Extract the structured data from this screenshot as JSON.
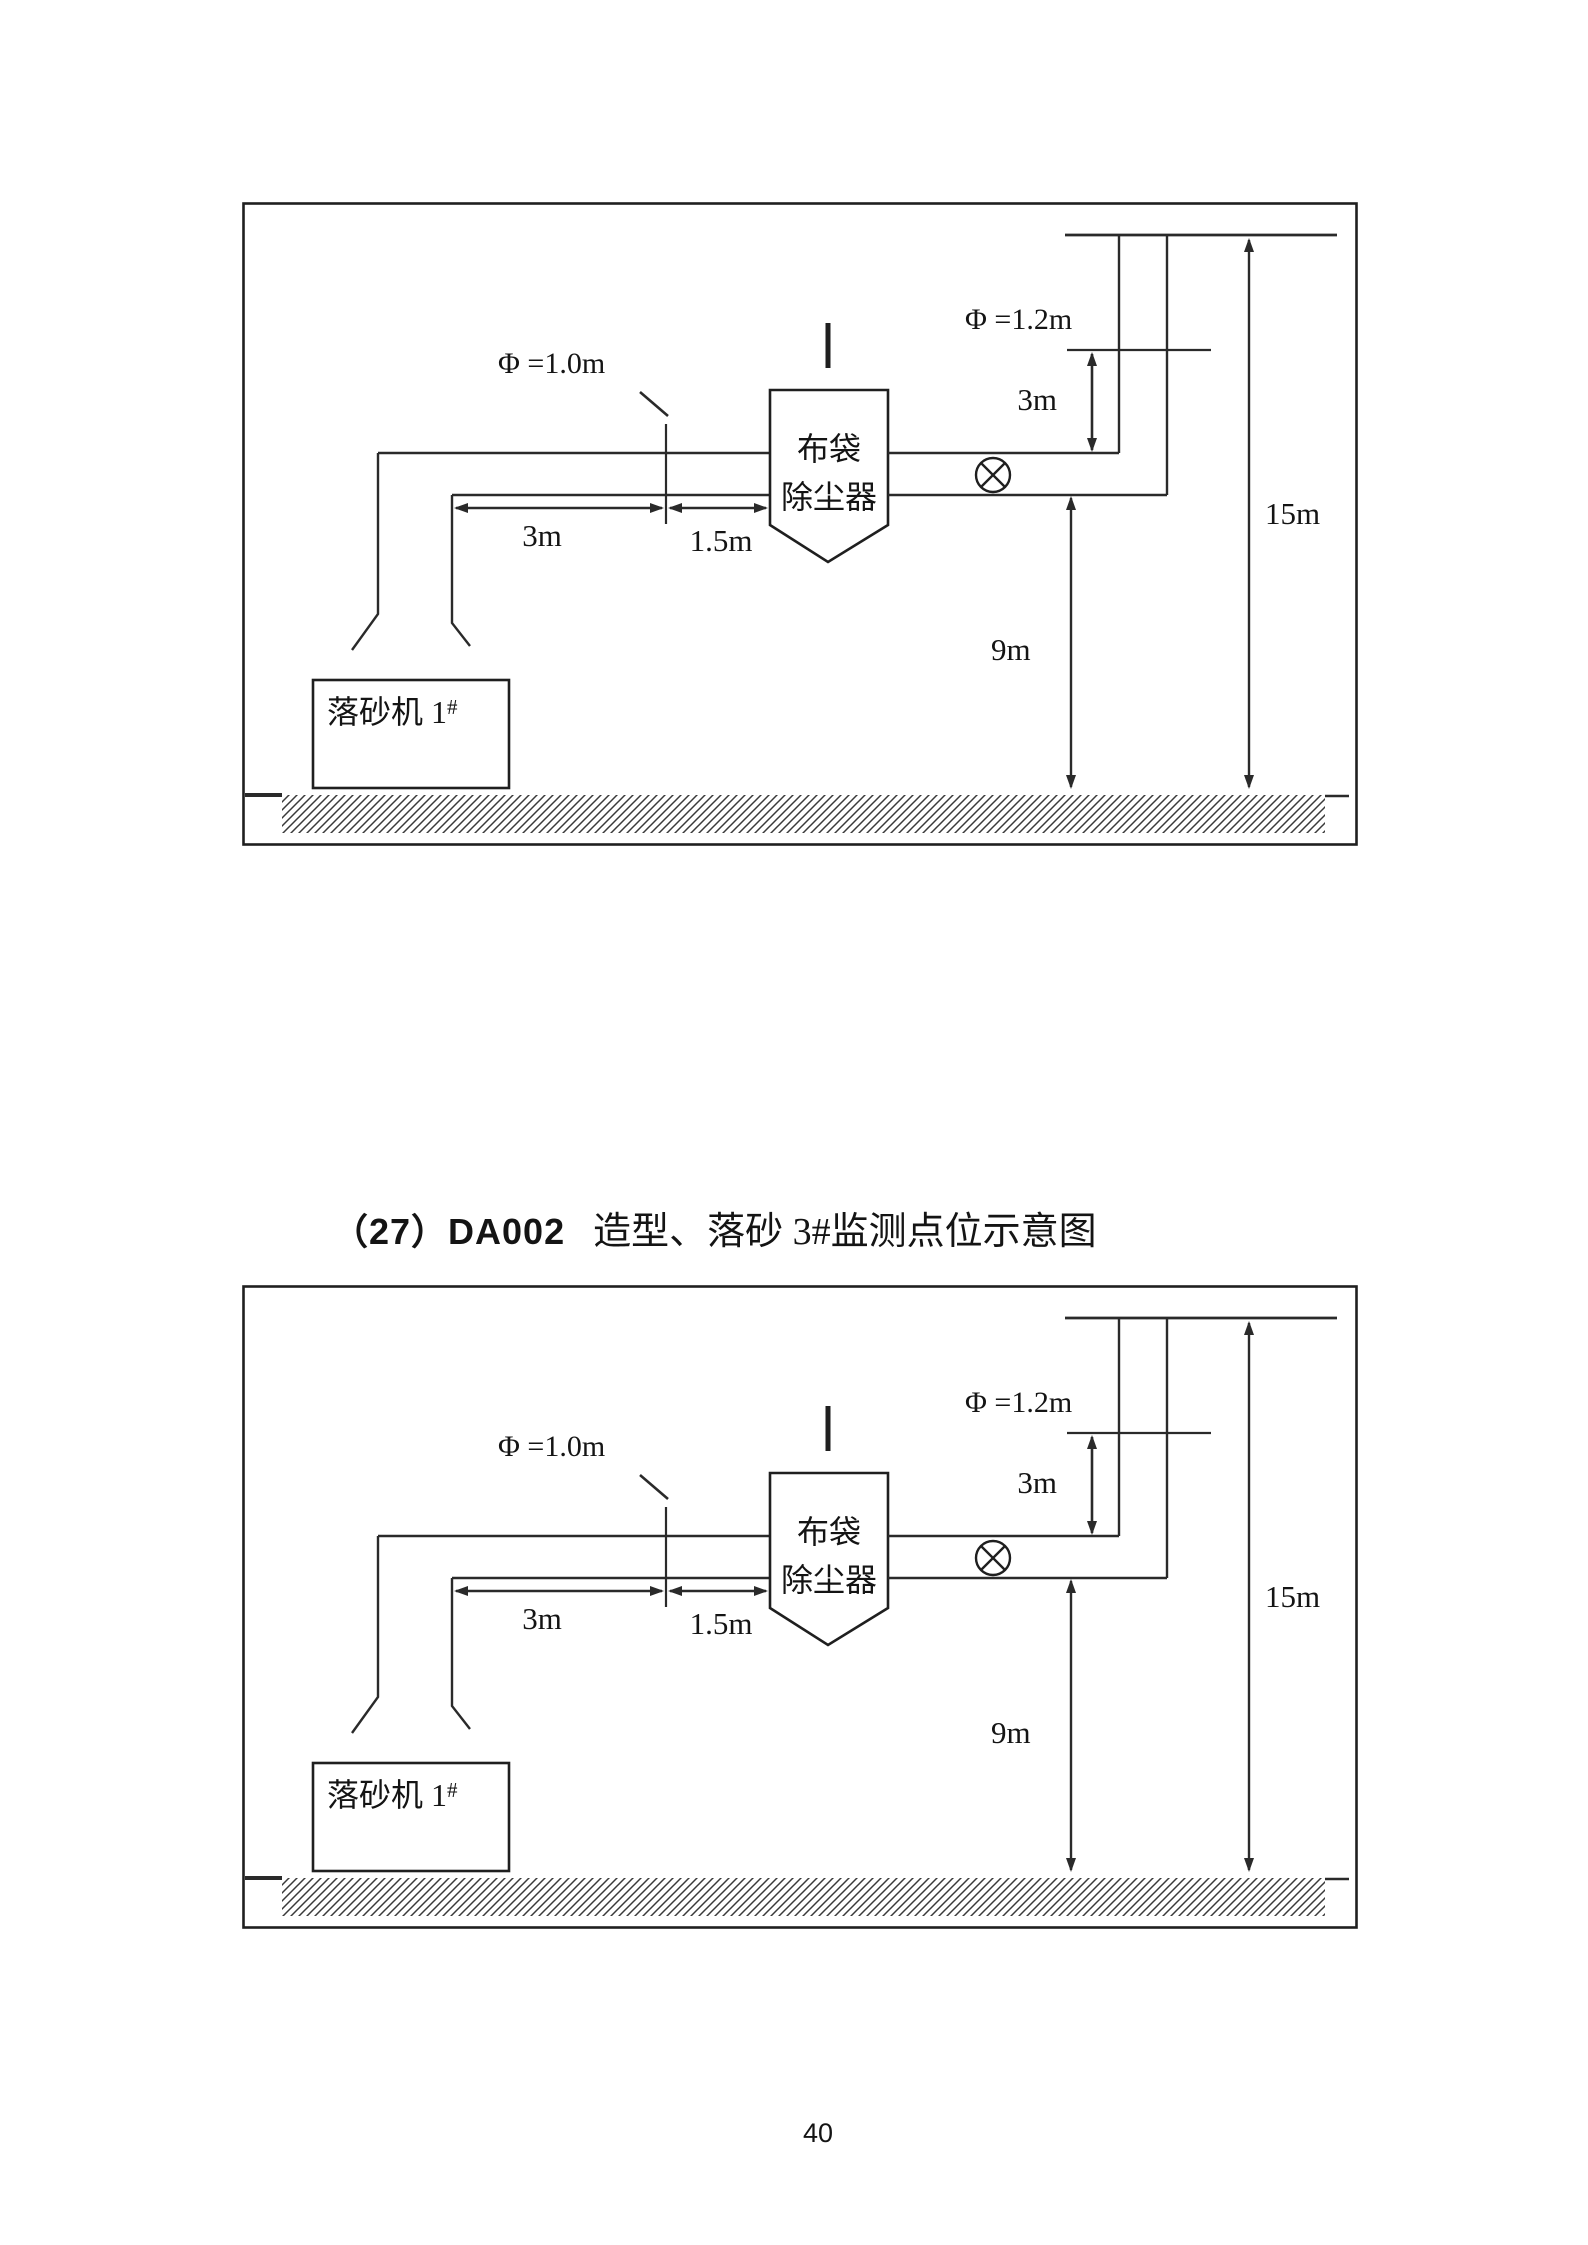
{
  "page": {
    "caption": {
      "number": "（27）DA002",
      "title": "造型、落砂 3#监测点位示意图"
    },
    "page_number": "40",
    "colors": {
      "background": "#ffffff",
      "line": "#2a2a2a",
      "text": "#141414"
    }
  },
  "diagram": {
    "labels": {
      "stack_diameter": "Φ =1.2m",
      "duct_diameter": "Φ =1.0m",
      "stack_port_height": "3m",
      "duct_run_length": "3m",
      "duct_port_distance": "1.5m",
      "duct_elevation": "9m",
      "stack_height": "15m",
      "collector_line1": "布袋",
      "collector_line2": "除尘器",
      "machine": "落砂机 1",
      "machine_sup": "#"
    },
    "symbols": {
      "monitoring_point": "circled-x-icon",
      "ground": "diagonal-hatch"
    }
  }
}
